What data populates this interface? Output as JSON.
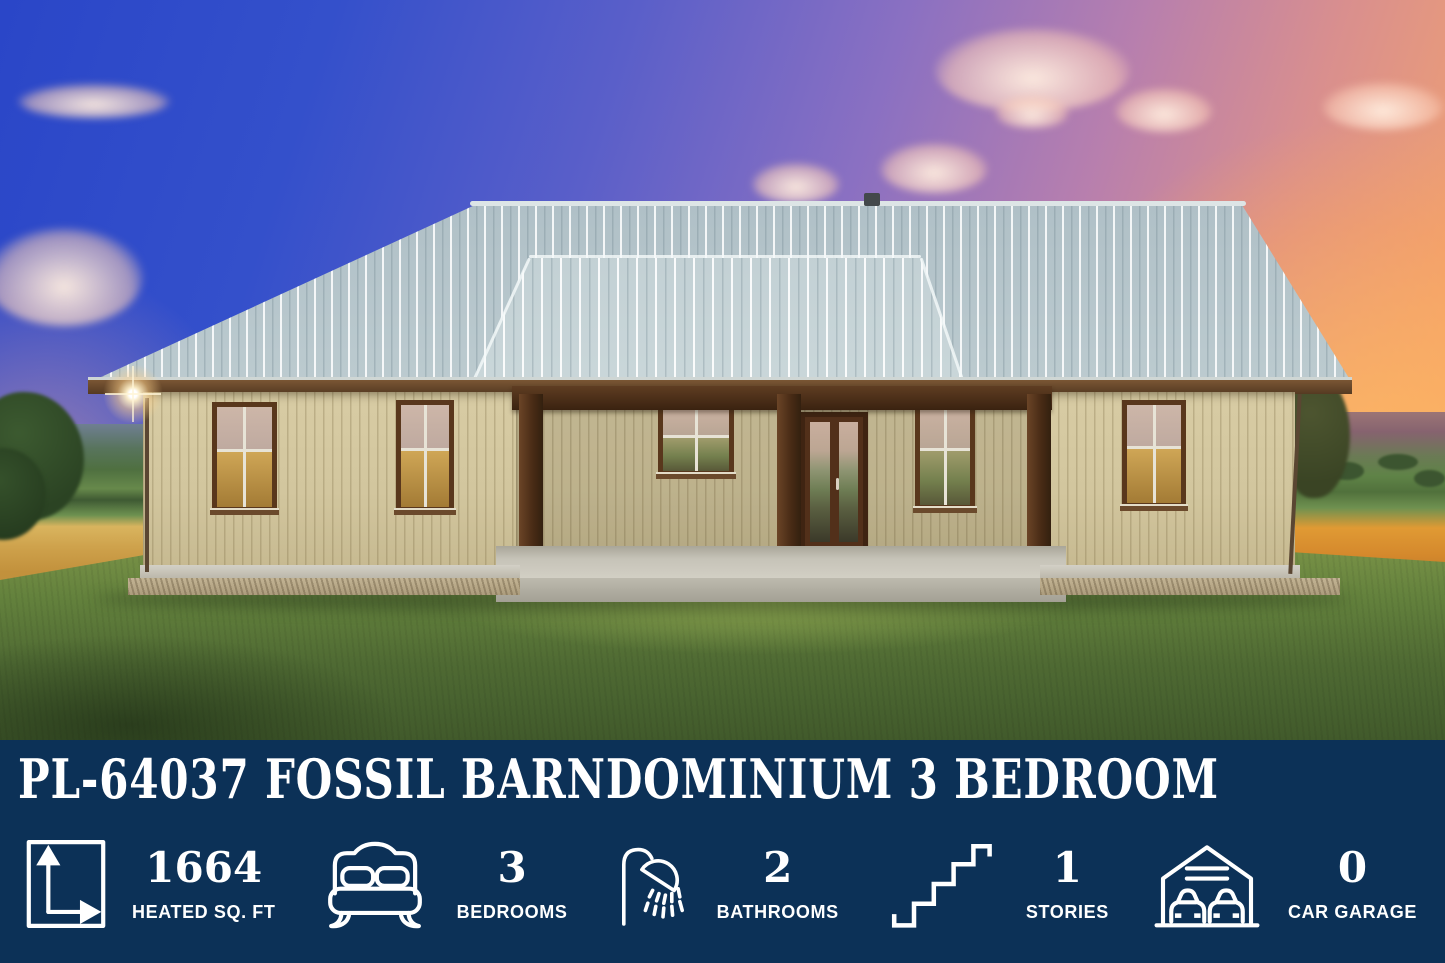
{
  "banner": {
    "title": "PL-64037 FOSSIL BARNDOMINIUM 3 BEDROOM",
    "background_color": "#0c3157",
    "text_color": "#ffffff",
    "stats": [
      {
        "icon": "area-dimensions-icon",
        "value": "1664",
        "label": "HEATED SQ. FT"
      },
      {
        "icon": "bed-icon",
        "value": "3",
        "label": "BEDROOMS"
      },
      {
        "icon": "shower-icon",
        "value": "2",
        "label": "BATHROOMS"
      },
      {
        "icon": "stairs-icon",
        "value": "1",
        "label": "STORIES"
      },
      {
        "icon": "garage-icon",
        "value": "0",
        "label": "CAR GARAGE"
      }
    ]
  },
  "photo": {
    "alt": "Tan single-story barndominium with silver standing-seam metal roof, dark wood porch posts, brown-framed windows and French doors, on a green lawn with rolling farm fields and golden wheat under a blue-to-orange sunset sky",
    "palette": {
      "sky_blue": "#2a46c8",
      "sunset_orange": "#f7ad62",
      "roof_gray": "#c3d0d4",
      "siding_tan": "#d2c69e",
      "trim_brown": "#4a2c16",
      "grass_green": "#5d7a3c"
    }
  }
}
